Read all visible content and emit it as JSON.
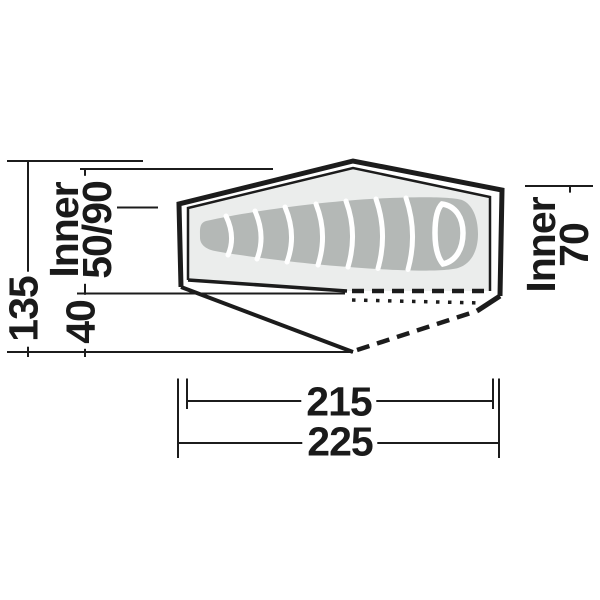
{
  "diagram": {
    "type": "tent-floorplan-technical-drawing",
    "dimensions": {
      "total_width": "135",
      "inner_width_label": "Inner",
      "inner_width_value": "50/90",
      "vestibule_depth": "40",
      "inner_right_label": "Inner",
      "inner_right_value": "70",
      "inner_length": "215",
      "total_length": "225"
    },
    "colors": {
      "line": "#1c1c1c",
      "tent_interior_fill": "#ebedec",
      "sleeping_bag_fill": "#b4b8b6",
      "seam": "#ffffff",
      "background": "#ffffff"
    }
  }
}
